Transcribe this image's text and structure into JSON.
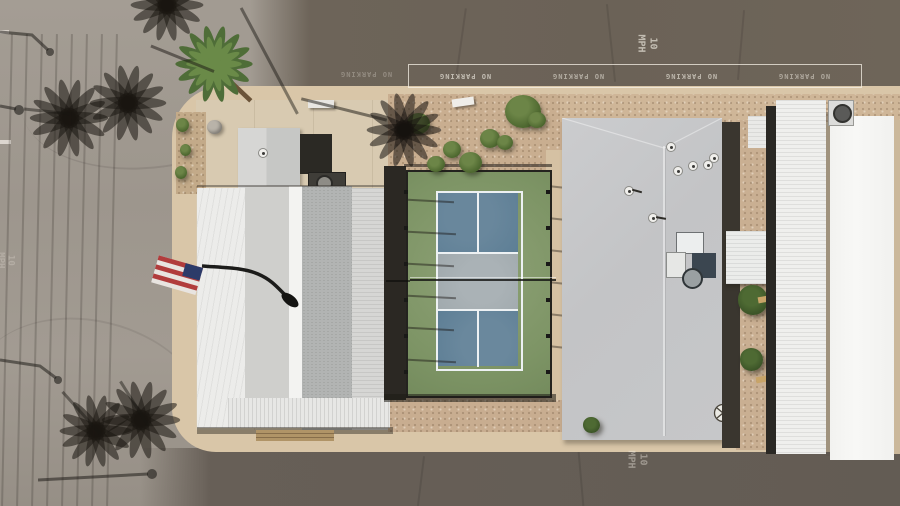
{
  "scene": {
    "type": "aerial-drone-photo",
    "subject": "mobile home park with pickleball court",
    "road_markings": {
      "no_parking": "NO PARKING",
      "speed_limit": "10 MPH"
    },
    "palette": {
      "asphalt_dark": "#6d6459",
      "asphalt_bottom": "#675f57",
      "road_light": "#a29b92",
      "curb_tan": "#d9c6a8",
      "gravel_pink": "#c9ae90",
      "concrete": "#d8cab1",
      "roof_white": "#f1f1ef",
      "roof_gray": "#c5c6c8",
      "roof_shingle": "#b2b4b3",
      "court_green": "#7d9465",
      "court_blue": "#5d7e95",
      "court_kitchen": "#a0a9ad",
      "line_white": "#edf1f3",
      "fence_dark": "#201f1c",
      "tree_green": "#4e6a33",
      "flag_red": "#b13c3c",
      "flag_blue": "#2c3b69"
    }
  }
}
